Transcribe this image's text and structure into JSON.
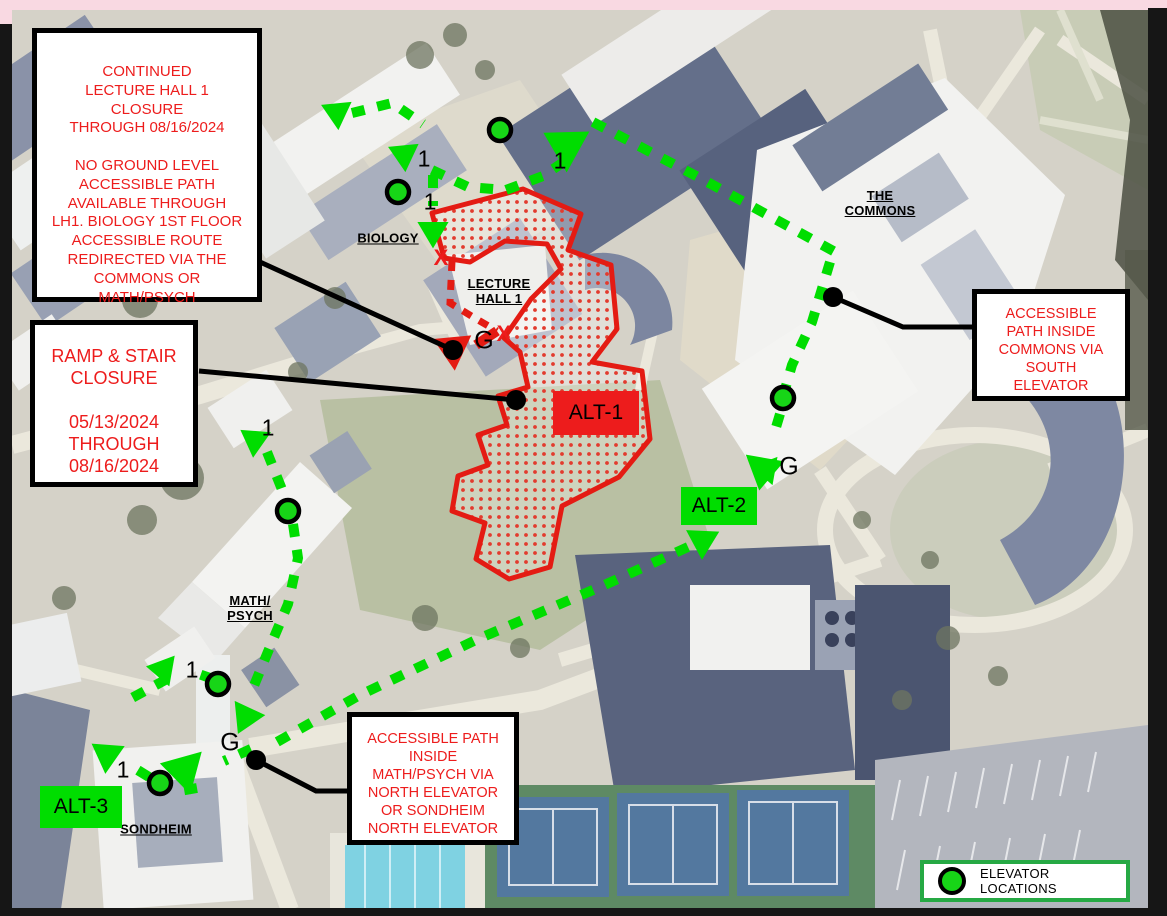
{
  "notes": {
    "lh1_closure": "CONTINUED\nLECTURE HALL 1\nCLOSURE\nTHROUGH 08/16/2024\n\nNO GROUND LEVEL\nACCESSIBLE PATH\nAVAILABLE THROUGH\nLH1. BIOLOGY 1ST FLOOR\nACCESSIBLE ROUTE\nREDIRECTED VIA THE\nCOMMONS OR\nMATH/PSYCH",
    "ramp_stair": "RAMP & STAIR\nCLOSURE\n\n05/13/2024\nTHROUGH\n08/16/2024",
    "commons_elevator": "ACCESSIBLE\nPATH INSIDE\nCOMMONS VIA\nSOUTH\nELEVATOR",
    "mathpsych_elevator": "ACCESSIBLE PATH\nINSIDE\nMATH/PSYCH VIA\nNORTH ELEVATOR\nOR SONDHEIM\nNORTH ELEVATOR"
  },
  "buildings": {
    "biology": "BIOLOGY",
    "lecture_hall": "LECTURE\nHALL 1",
    "commons": "THE\nCOMMONS",
    "math_psych": "MATH/\nPSYCH",
    "sondheim": "SONDHEIM"
  },
  "badges": {
    "alt1": "ALT-1",
    "alt2": "ALT-2",
    "alt3": "ALT-3"
  },
  "legend": {
    "elevator_locations": "ELEVATOR LOCATIONS"
  },
  "route_markers": {
    "first_floor": "1",
    "ground": "G",
    "closed": "X"
  },
  "colors": {
    "route_green": "#00dd00",
    "closure_red": "#ed1c1c",
    "legend_green": "#26a944",
    "elevator_green": "#17d517",
    "frame_pink": "#f9d9e2"
  }
}
